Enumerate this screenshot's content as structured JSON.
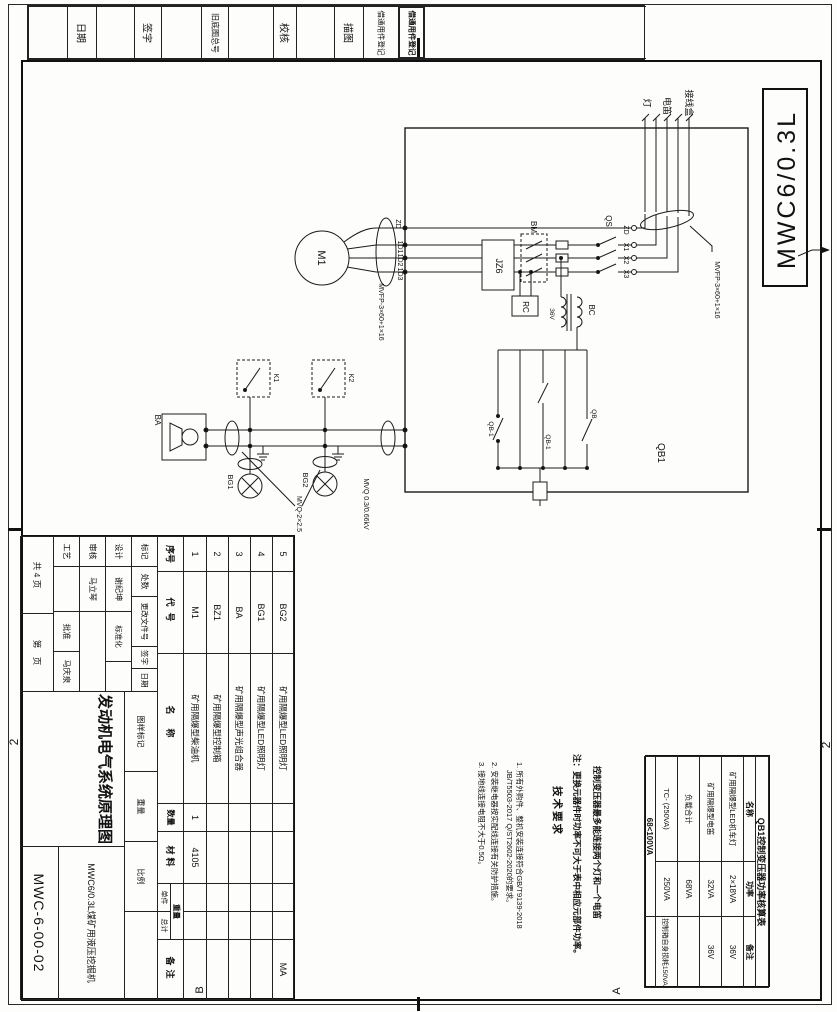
{
  "sheet": {
    "corner_model": "MWC6/0.3L",
    "zone_left": "2",
    "zone_right": "2",
    "zone_b": "B",
    "zone_a": "A"
  },
  "strip": {
    "cells": [
      "日期",
      "签字",
      "旧底图总号",
      "校核",
      "描图",
      "借通用件登记",
      "借通用件登记"
    ]
  },
  "title_block": {
    "rev_headers": [
      "标记",
      "处数",
      "更改文件号",
      "签字",
      "日期"
    ],
    "design_label": "设计",
    "design_name": "谢纪坤",
    "standard_label": "标准化",
    "check_label": "审核",
    "check_name": "马立琴",
    "process_label": "工艺",
    "approve_label": "批准",
    "approve_name": "马庆泉",
    "pages_total": "共 4 页",
    "page_no": "第　页",
    "stage_label": "图样标记",
    "weight_label": "重量",
    "scale_label": "比例",
    "drawing_title": "发动机电气系统原理图",
    "machine_model": "MWC6/0.3L煤矿用液压挖掘机",
    "drawing_number": "MWC-6-00-02"
  },
  "parts_list": {
    "h_no": "序号",
    "h_code": "代号",
    "h_name": "名称",
    "h_qty": "数量",
    "h_mat": "材料",
    "h_weight": "重量",
    "h_unit": "单件",
    "h_total": "总计",
    "h_note": "备注",
    "rows": [
      {
        "no": "5",
        "code": "BG2",
        "name": "矿用隔爆型LED照明灯",
        "qty": "",
        "mat": "",
        "note": "MA"
      },
      {
        "no": "4",
        "code": "BG1",
        "name": "矿用隔爆型LED照明灯",
        "qty": "",
        "mat": "",
        "note": ""
      },
      {
        "no": "3",
        "code": "BA",
        "name": "矿用隔爆型声光组合器",
        "qty": "",
        "mat": "",
        "note": ""
      },
      {
        "no": "2",
        "code": "BZ1",
        "name": "矿用隔爆型控制箱",
        "qty": "",
        "mat": "",
        "note": ""
      },
      {
        "no": "1",
        "code": "M1",
        "name": "矿用隔爆型柴油机",
        "qty": "1",
        "mat": "4105",
        "note": ""
      }
    ]
  },
  "tech_req": {
    "title": "技术要求",
    "line1": "1. 所有外购件、整机安装连接符合GB/T9139-2018",
    "line2": "JB/T5503-2017 Q/ST2602-2020的要求。",
    "line3": "2. 安装继电器按实配线连接有关防护措施。",
    "line4": "3. 接地线连接电阻不大于0.5Ω。"
  },
  "notes": {
    "line1": "控制变压器最多能连接两个灯和一个电笛",
    "line2": "注：更换元器件时功率不可大于表中相应元部件功率。"
  },
  "power_table": {
    "title": "QB1控制变压器功率核算表",
    "h_name": "名称",
    "h_power": "功率",
    "h_note": "备注",
    "rows": [
      {
        "name": "矿用隔爆型LED机车灯",
        "power": "2×18VA",
        "note": "36V"
      },
      {
        "name": "矿用隔爆型电笛",
        "power": "32VA",
        "note": "36V"
      },
      {
        "name": "负载合计",
        "power": "68VA",
        "note": ""
      },
      {
        "name": "TC- (250VA)",
        "power": "250VA",
        "note": "控制箱自身损耗150VA"
      }
    ],
    "footer": "68<100VA"
  },
  "schematic": {
    "motor": "M1",
    "contactor": "JZ6",
    "rc": "RC",
    "transformer": "BC",
    "tx_volt": "36V",
    "bm": "BM",
    "qs": "QS",
    "qb1_box": "QB1",
    "wire1": "1D1",
    "wire2": "1D2",
    "wire3": "1D3",
    "gnd": "ZD",
    "t_zd": "ZD",
    "t_x1": "X1",
    "t_x2": "X2",
    "t_x3": "X3",
    "lamp_label": "灯",
    "horn_label": "电笛",
    "jbox_label": "接线盒",
    "cable_spec": "MVFP-3×60+1×16",
    "cable2": "MVQ-2×2.5",
    "cable3": "MVQ 0.3/0.66kV",
    "ba": "BA",
    "bg1": "BG1",
    "bg2": "BG2",
    "k1": "K1",
    "k2": "K2",
    "qb_contact": "QB-1",
    "qb": "QB"
  }
}
